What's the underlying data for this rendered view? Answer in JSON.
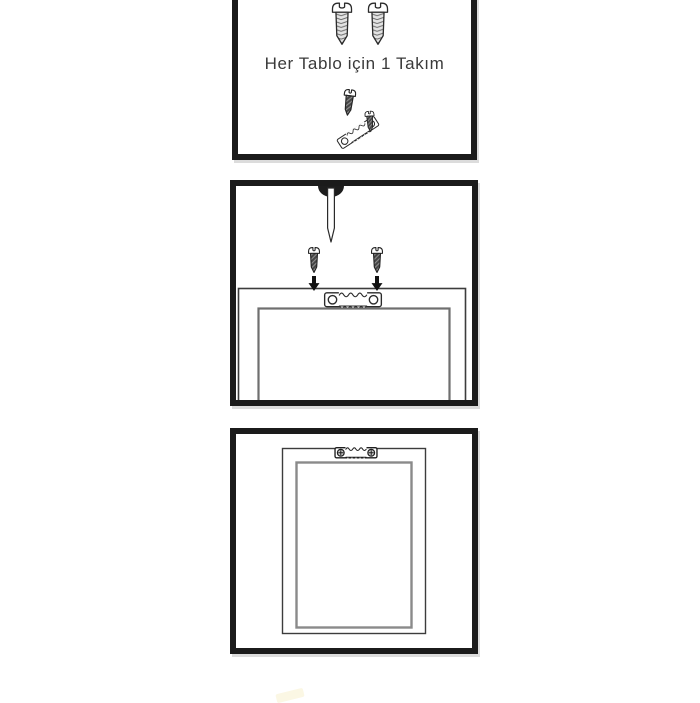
{
  "caption_panel": {
    "caption": "Her Tablo için 1 Takım"
  },
  "panels": [
    {
      "name": "hardware-kit",
      "caption": "Her Tablo için 1 Takım",
      "icons": [
        "screw-icon",
        "screw-icon",
        "screw-icon",
        "sawtooth-hanger-icon",
        "screw-icon"
      ]
    },
    {
      "name": "installation-step",
      "icons": [
        "nail-icon",
        "screw-icon",
        "screw-icon",
        "arrow-down-icon",
        "arrow-down-icon",
        "sawtooth-hanger-icon",
        "frame-top-outline"
      ]
    },
    {
      "name": "mounted-frame-back",
      "icons": [
        "sawtooth-hanger-installed-icon",
        "frame-back-outline"
      ]
    }
  ],
  "colors": {
    "background": "#ffffff",
    "panel_border": "#1b1b1b",
    "panel_shadow": "#dcdcdc",
    "line_dark": "#2b2b2b",
    "frame_outer_gray": "#3c3c3c",
    "frame_inner_gray": "#8a8a8a",
    "caption_color": "#3a3a3a",
    "artifact_color": "#fbf7e4"
  }
}
